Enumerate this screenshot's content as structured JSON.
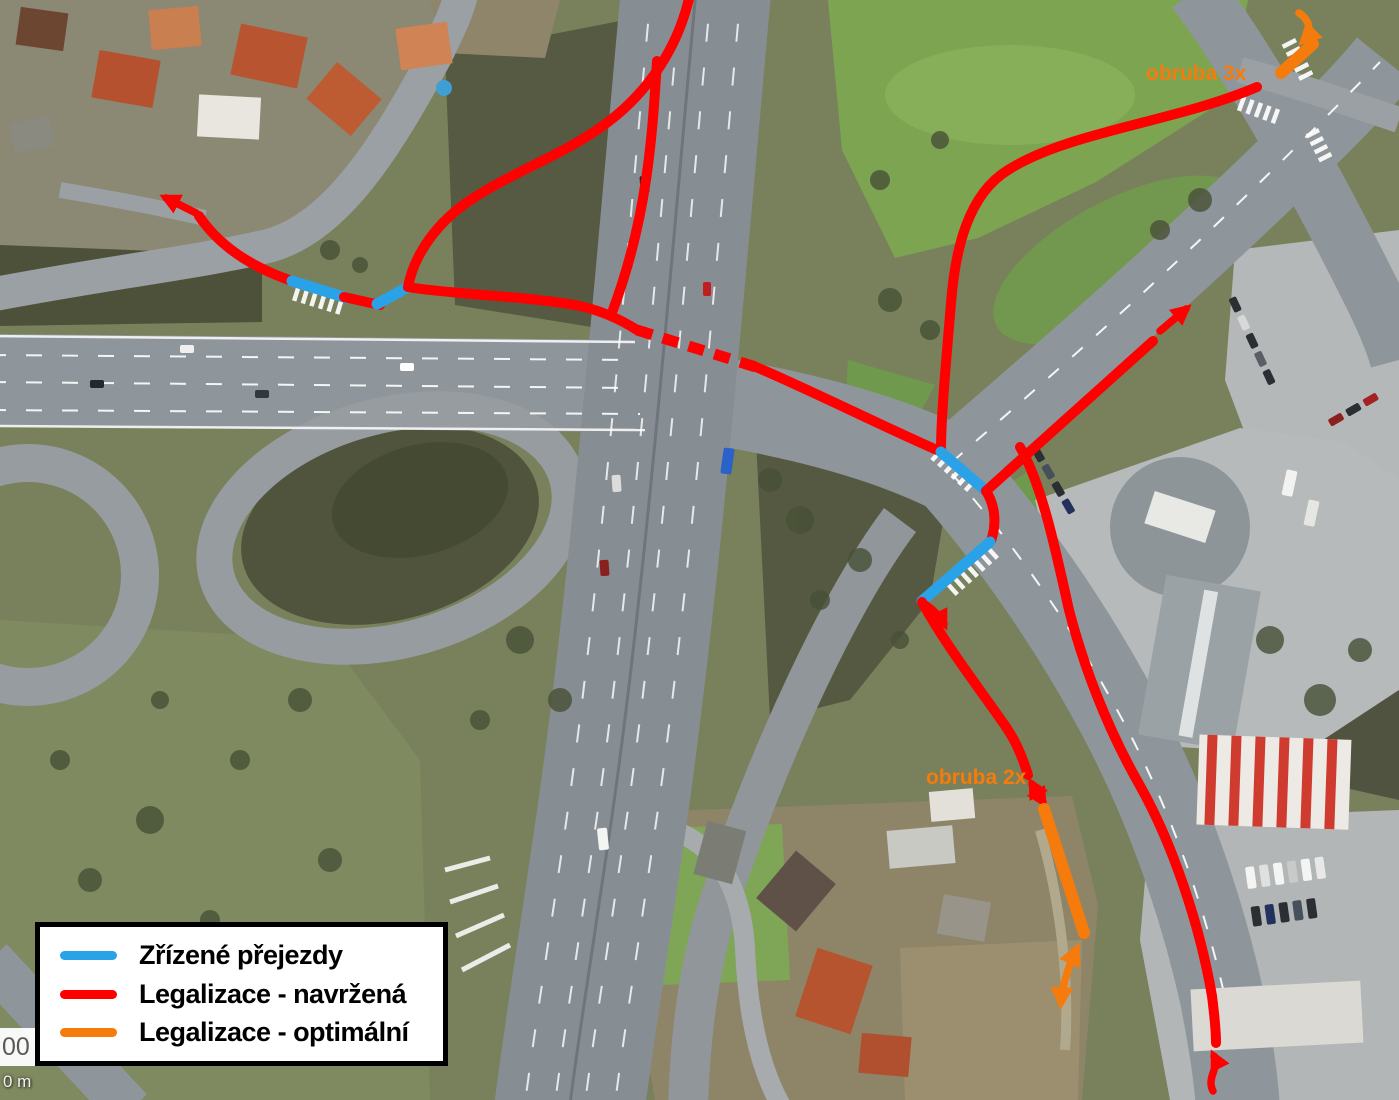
{
  "map": {
    "kind": "aerial-annotation-map",
    "annotation_labels": {
      "obruba_3x": "obruba 3x",
      "obruba_2x": "obruba 2x"
    },
    "scale_partial": {
      "number": "00",
      "unit_label": "0 m"
    }
  },
  "legend": {
    "items": [
      {
        "id": "zrizene-prejezdy",
        "label": "Zřízené přejezdy",
        "color": "#2aa2e8"
      },
      {
        "id": "legalizace-navrzena",
        "label": "Legalizace - navržená",
        "color": "#ff0000"
      },
      {
        "id": "legalizace-optimalni",
        "label": "Legalizace - optimální",
        "color": "#f57b0c"
      }
    ]
  },
  "colors": {
    "crossing_blue": "#2aa2e8",
    "route_red": "#ff0000",
    "route_orange": "#f57b0c",
    "legend_border": "#000000",
    "legend_background": "#ffffff"
  }
}
